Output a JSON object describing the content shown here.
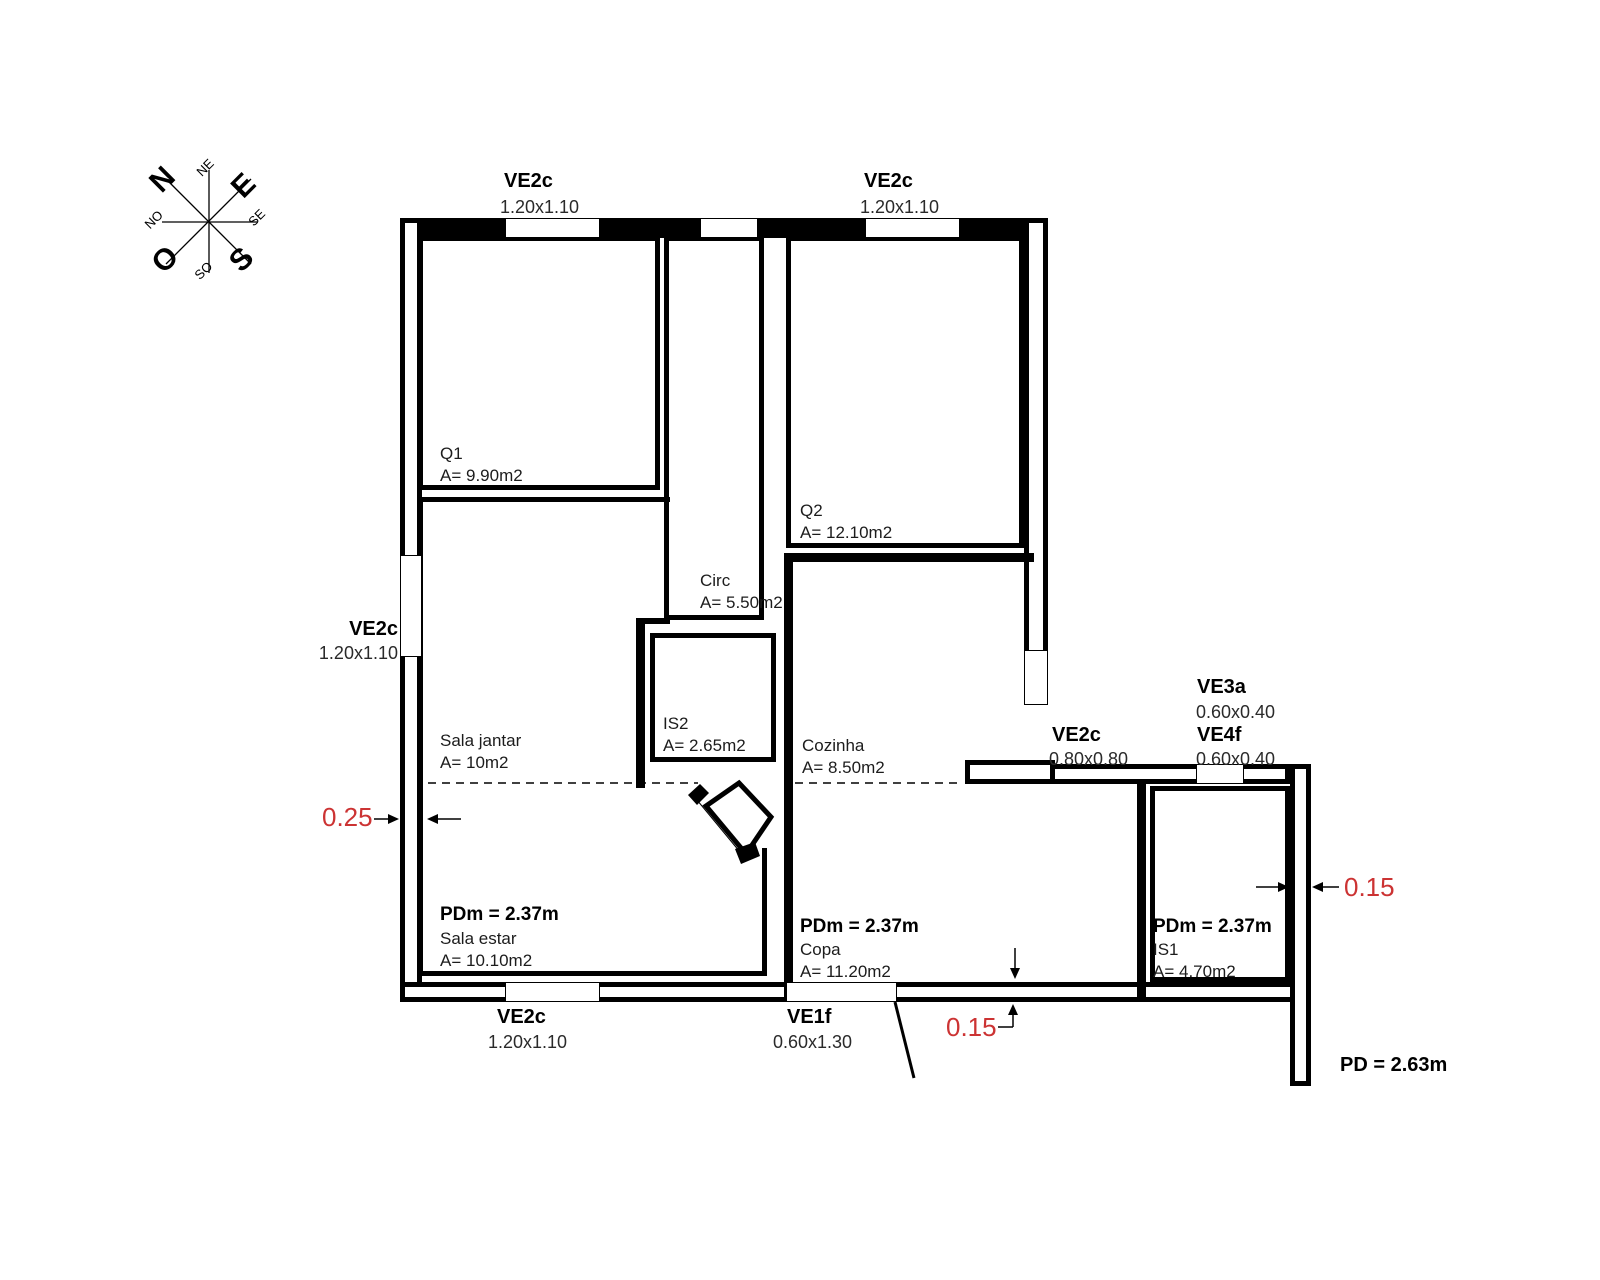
{
  "compass": {
    "n": "N",
    "ne": "NE",
    "e": "E",
    "se": "SE",
    "s": "S",
    "so": "SO",
    "o": "O",
    "no": "NO"
  },
  "rooms": {
    "q1": {
      "name": "Q1",
      "area": "A= 9.90m2"
    },
    "q2": {
      "name": "Q2",
      "area": "A= 12.10m2"
    },
    "circ": {
      "name": "Circ",
      "area": "A= 5.50m2"
    },
    "is2": {
      "name": "IS2",
      "area": "A= 2.65m2"
    },
    "sala_jantar": {
      "name": "Sala jantar",
      "area": "A= 10m2"
    },
    "cozinha": {
      "name": "Cozinha",
      "area": "A= 8.50m2"
    },
    "sala_estar": {
      "name": "Sala estar",
      "area": "A= 10.10m2",
      "ceiling_height": "PDm = 2.37m"
    },
    "copa": {
      "name": "Copa",
      "area": "A= 11.20m2",
      "ceiling_height": "PDm = 2.37m"
    },
    "is1": {
      "name": "IS1",
      "area": "A= 4.70m2",
      "ceiling_height": "PDm = 2.37m"
    }
  },
  "windows": {
    "top_left": {
      "code": "VE2c",
      "size": "1.20x1.10"
    },
    "top_right": {
      "code": "VE2c",
      "size": "1.20x1.10"
    },
    "left": {
      "code": "VE2c",
      "size": "1.20x1.10"
    },
    "bottom": {
      "code": "VE2c",
      "size": "1.20x1.10"
    },
    "entry": {
      "code": "VE1f",
      "size": "0.60x1.30"
    },
    "kitchen": {
      "code": "VE2c",
      "size": "0.80x0.80"
    },
    "bath_a": {
      "code": "VE3a",
      "size": "0.60x0.40"
    },
    "bath_f": {
      "code": "VE4f",
      "size": "0.60x0.40"
    }
  },
  "dimensions": {
    "left_wall_thickness": "0.25",
    "right_wall_thickness": "0.15",
    "bottom_wall_thickness": "0.15",
    "ceiling_overall": "PD = 2.63m"
  },
  "colors": {
    "dimension_red": "#cc3333",
    "line": "#000000"
  }
}
